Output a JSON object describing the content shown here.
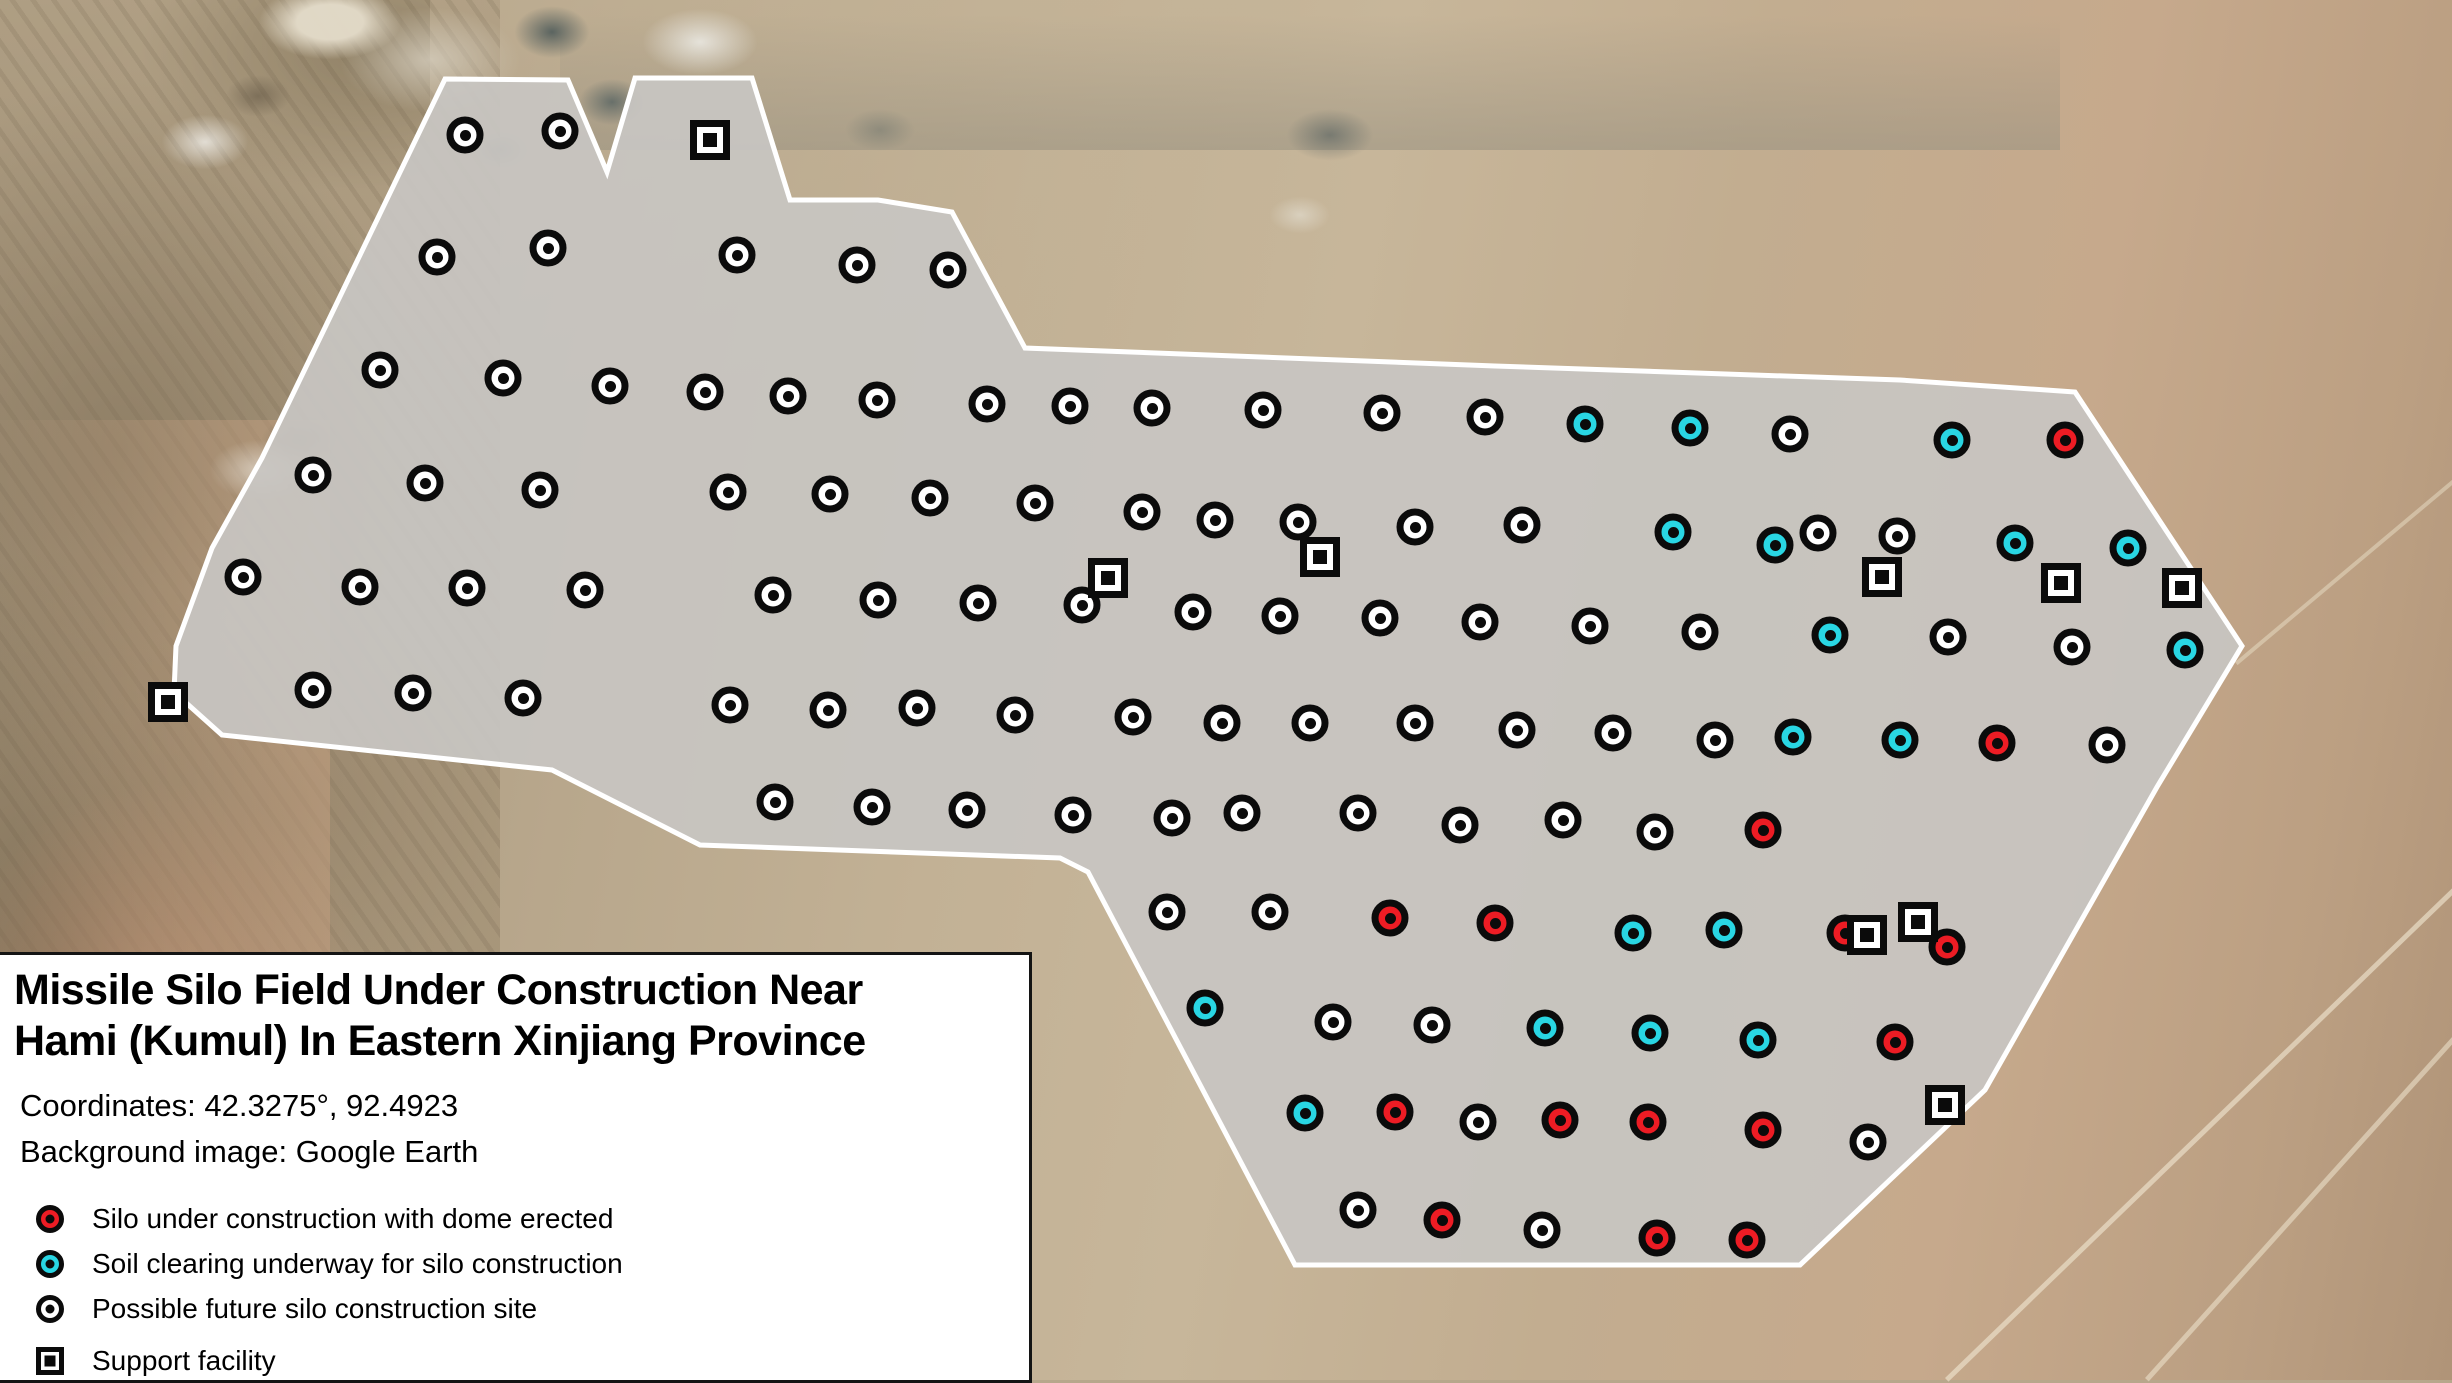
{
  "info_panel": {
    "title_line1": "Missile Silo Field Under Construction Near",
    "title_line2": "Hami (Kumul) In Eastern Xinjiang Province",
    "coordinates": "Coordinates: 42.3275°, 92.4923",
    "background_image": "Background image: Google Earth",
    "legend": [
      {
        "key": "dome",
        "shape": "circle",
        "color": "#ed1c24",
        "label": "Silo under construction with dome erected"
      },
      {
        "key": "clearing",
        "shape": "circle",
        "color": "#29d6e3",
        "label": "Soil clearing underway for silo construction"
      },
      {
        "key": "future",
        "shape": "circle",
        "color": "#ffffff",
        "label": "Possible future silo construction site"
      },
      {
        "key": "support",
        "shape": "square",
        "color": "#ffffff",
        "label": "Support facility"
      }
    ]
  },
  "map": {
    "field_fill": "#c8c6c2",
    "field_fill_opacity": 0.92,
    "field_stroke": "#ffffff",
    "field_stroke_width": 5,
    "field_boundary": [
      [
        445,
        79
      ],
      [
        568,
        80
      ],
      [
        607,
        172
      ],
      [
        635,
        78
      ],
      [
        752,
        78
      ],
      [
        790,
        200
      ],
      [
        878,
        200
      ],
      [
        952,
        212
      ],
      [
        1025,
        348
      ],
      [
        1495,
        366
      ],
      [
        1900,
        380
      ],
      [
        2075,
        392
      ],
      [
        2242,
        646
      ],
      [
        2157,
        787
      ],
      [
        1985,
        1090
      ],
      [
        1800,
        1265
      ],
      [
        1295,
        1265
      ],
      [
        1088,
        872
      ],
      [
        1060,
        858
      ],
      [
        700,
        845
      ],
      [
        552,
        770
      ],
      [
        222,
        735
      ],
      [
        174,
        692
      ],
      [
        176,
        646
      ],
      [
        212,
        548
      ],
      [
        262,
        458
      ]
    ],
    "marker_groups": [
      {
        "key": "future",
        "name": "possible-future-silo-marker",
        "shape": "circle",
        "color": "#ffffff",
        "points": [
          [
            465,
            135
          ],
          [
            560,
            131
          ],
          [
            437,
            257
          ],
          [
            548,
            248
          ],
          [
            737,
            255
          ],
          [
            857,
            265
          ],
          [
            948,
            270
          ],
          [
            380,
            370
          ],
          [
            503,
            378
          ],
          [
            610,
            386
          ],
          [
            705,
            392
          ],
          [
            788,
            396
          ],
          [
            877,
            400
          ],
          [
            987,
            404
          ],
          [
            1070,
            406
          ],
          [
            1152,
            408
          ],
          [
            1263,
            410
          ],
          [
            1382,
            413
          ],
          [
            1485,
            417
          ],
          [
            1790,
            434
          ],
          [
            313,
            475
          ],
          [
            425,
            483
          ],
          [
            540,
            490
          ],
          [
            728,
            492
          ],
          [
            830,
            494
          ],
          [
            930,
            498
          ],
          [
            1035,
            503
          ],
          [
            1142,
            512
          ],
          [
            1215,
            520
          ],
          [
            1298,
            522
          ],
          [
            1415,
            527
          ],
          [
            1522,
            525
          ],
          [
            1818,
            533
          ],
          [
            1897,
            536
          ],
          [
            243,
            577
          ],
          [
            360,
            587
          ],
          [
            467,
            588
          ],
          [
            585,
            590
          ],
          [
            773,
            595
          ],
          [
            878,
            600
          ],
          [
            978,
            603
          ],
          [
            1082,
            605
          ],
          [
            1193,
            612
          ],
          [
            1280,
            616
          ],
          [
            1380,
            618
          ],
          [
            1480,
            622
          ],
          [
            1590,
            626
          ],
          [
            1700,
            632
          ],
          [
            1948,
            637
          ],
          [
            2072,
            647
          ],
          [
            313,
            690
          ],
          [
            413,
            693
          ],
          [
            523,
            698
          ],
          [
            730,
            705
          ],
          [
            828,
            710
          ],
          [
            917,
            708
          ],
          [
            1015,
            715
          ],
          [
            1133,
            717
          ],
          [
            1222,
            723
          ],
          [
            1310,
            723
          ],
          [
            1415,
            723
          ],
          [
            1517,
            730
          ],
          [
            1613,
            733
          ],
          [
            1715,
            740
          ],
          [
            2107,
            745
          ],
          [
            775,
            802
          ],
          [
            872,
            807
          ],
          [
            967,
            810
          ],
          [
            1073,
            815
          ],
          [
            1172,
            818
          ],
          [
            1242,
            813
          ],
          [
            1358,
            813
          ],
          [
            1460,
            825
          ],
          [
            1563,
            820
          ],
          [
            1655,
            832
          ],
          [
            1167,
            912
          ],
          [
            1270,
            912
          ],
          [
            1333,
            1022
          ],
          [
            1432,
            1025
          ],
          [
            1478,
            1122
          ],
          [
            1868,
            1142
          ],
          [
            1358,
            1210
          ],
          [
            1542,
            1230
          ]
        ]
      },
      {
        "key": "clearing",
        "name": "soil-clearing-marker",
        "shape": "circle",
        "color": "#29d6e3",
        "points": [
          [
            1585,
            424
          ],
          [
            1690,
            428
          ],
          [
            1952,
            440
          ],
          [
            1673,
            532
          ],
          [
            1775,
            545
          ],
          [
            2015,
            543
          ],
          [
            2128,
            548
          ],
          [
            1830,
            635
          ],
          [
            2185,
            650
          ],
          [
            1793,
            737
          ],
          [
            1900,
            740
          ],
          [
            1633,
            933
          ],
          [
            1724,
            930
          ],
          [
            1205,
            1008
          ],
          [
            1545,
            1028
          ],
          [
            1650,
            1033
          ],
          [
            1758,
            1040
          ],
          [
            1305,
            1113
          ]
        ]
      },
      {
        "key": "dome",
        "name": "silo-dome-marker",
        "shape": "circle",
        "color": "#ed1c24",
        "points": [
          [
            2065,
            440
          ],
          [
            1997,
            743
          ],
          [
            1763,
            830
          ],
          [
            1390,
            918
          ],
          [
            1495,
            923
          ],
          [
            1845,
            933
          ],
          [
            1947,
            947
          ],
          [
            1895,
            1042
          ],
          [
            1395,
            1112
          ],
          [
            1560,
            1120
          ],
          [
            1648,
            1122
          ],
          [
            1763,
            1130
          ],
          [
            1442,
            1220
          ],
          [
            1657,
            1238
          ],
          [
            1747,
            1240
          ]
        ]
      },
      {
        "key": "support",
        "name": "support-facility-marker",
        "shape": "square",
        "color": "#ffffff",
        "points": [
          [
            710,
            140
          ],
          [
            168,
            702
          ],
          [
            1108,
            578
          ],
          [
            1320,
            557
          ],
          [
            1882,
            577
          ],
          [
            2061,
            583
          ],
          [
            2182,
            588
          ],
          [
            1867,
            935
          ],
          [
            1918,
            922
          ],
          [
            1945,
            1105
          ]
        ]
      }
    ]
  }
}
